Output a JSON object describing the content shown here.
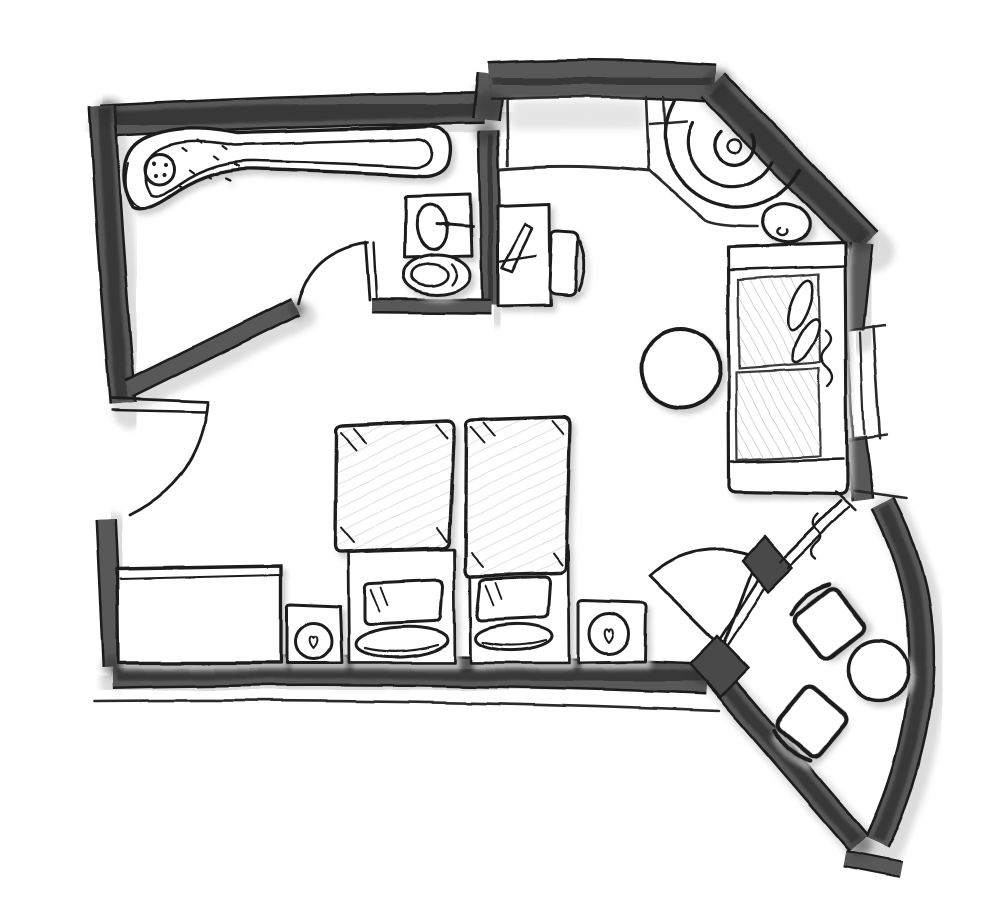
{
  "meta": {
    "title": "Hand-drawn floor plan sketch — hotel room with bathroom and round balcony",
    "style": "black marker sketch on white paper, no text labels"
  },
  "colors": {
    "background": "#ffffff",
    "ink": "#1f1f1f",
    "wall_body": "#585858",
    "wall_core": "#383838",
    "wall_shadow": "#dcdcdc",
    "furniture_shadow": "#c9c9c9",
    "hatch": "#8a8a8a"
  },
  "areas": {
    "bathroom": {
      "label": "bathroom with bathtub, washbasin and toilet"
    },
    "entry": {
      "label": "entry zone with closet niche, corner shower and toilet"
    },
    "bedroom": {
      "label": "bedroom with two twin beds, nightstands, dresser, desk, wardrobe and stool"
    },
    "balcony": {
      "label": "rounded balcony with two chairs and round table"
    }
  },
  "fixtures": {
    "bathtub": "bathtub",
    "washbasin": "washbasin",
    "toilet_bathroom": "toilet",
    "bathroom_door": "bathroom door swing",
    "entrance_door": "entrance door swing",
    "closet_niche": "closet niche",
    "corner_shower": "corner shower",
    "toilet_entry": "round toilet",
    "wardrobe": "wardrobe with clothes and hangers",
    "window": "window",
    "stool": "round stool",
    "desk": "desk with monitor",
    "desk_chair": "desk chair",
    "dresser": "dresser / luggage bench",
    "nightstand_left": "nightstand with lamp",
    "nightstand_right": "nightstand with lamp",
    "bed_left": "twin bed with duvet and pillow",
    "bed_right": "twin bed with duvet and pillow",
    "balcony_door": "balcony door swing",
    "balcony_table": "round balcony table",
    "balcony_chair_upper": "balcony chair",
    "balcony_chair_lower": "balcony chair",
    "parapet": "curved balcony parapet"
  }
}
